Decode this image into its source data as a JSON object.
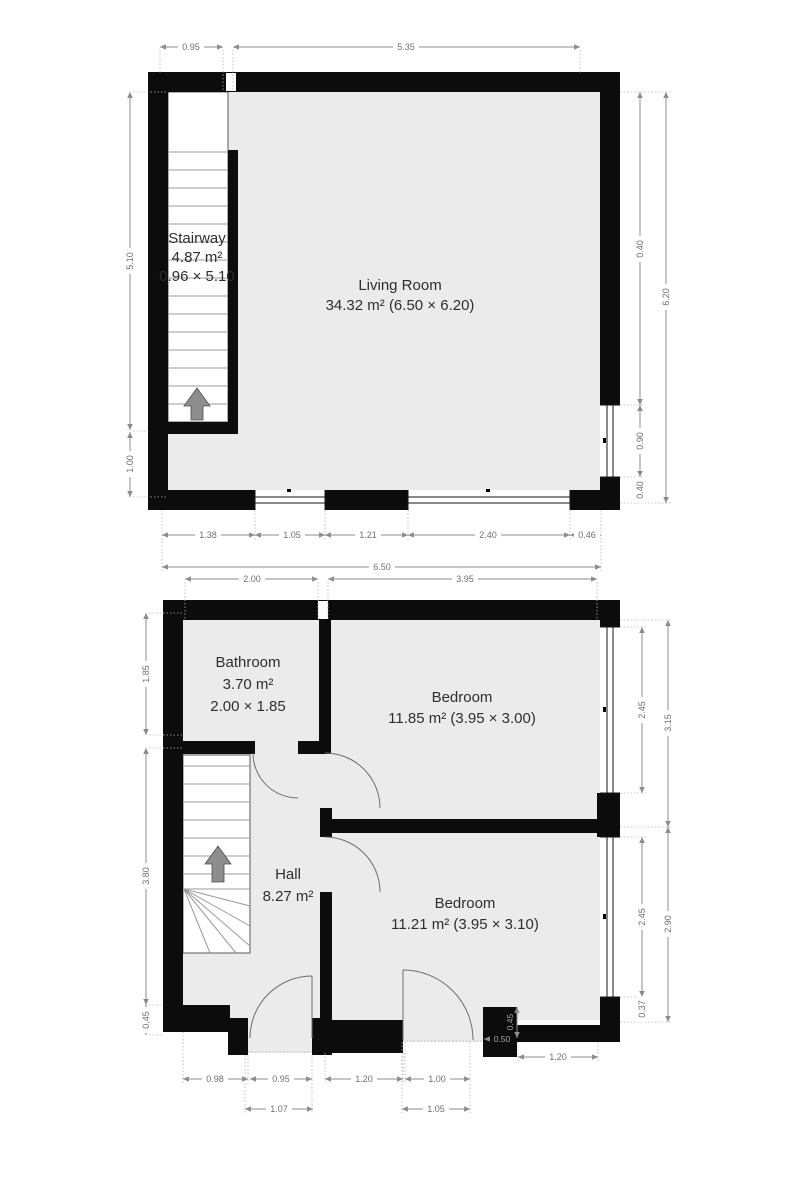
{
  "floor1": {
    "rooms": {
      "stairway": {
        "name": "Stairway",
        "area": "4.87 m²",
        "size": "0.96 × 5.10"
      },
      "living_room": {
        "name": "Living Room",
        "detail": "34.32 m² (6.50 × 6.20)"
      }
    },
    "dims": {
      "top_left": "0.95",
      "top_main": "5.35",
      "left_upper": "5.10",
      "left_lower": "1.00",
      "right_upper": "0.40",
      "right_window": "0.90",
      "right_lower": "0.40",
      "right_total": "6.20",
      "bottom_segments": [
        "1.38",
        "1.05",
        "1.21",
        "2.40",
        "0.46"
      ],
      "width_total": "6.50"
    }
  },
  "floor2": {
    "rooms": {
      "bathroom": {
        "name": "Bathroom",
        "area": "3.70 m²",
        "size": "2.00 × 1.85"
      },
      "bedroom_top": {
        "name": "Bedroom",
        "detail": "11.85 m² (3.95 × 3.00)"
      },
      "hall": {
        "name": "Hall",
        "area": "8.27 m²"
      },
      "bedroom_bottom": {
        "name": "Bedroom",
        "detail": "11.21 m² (3.95 × 3.10)"
      }
    },
    "dims": {
      "top_left": "2.00",
      "top_right": "3.95",
      "left_upper": "1.85",
      "left_mid": "3.80",
      "left_lower": "0.45",
      "right_window_top": "2.45",
      "right_section_top": "3.15",
      "right_window_bottom": "2.45",
      "right_section_bottom": "2.90",
      "right_step": "0.37",
      "bottom_right": "1.20",
      "bottom_segments": [
        "0.98",
        "0.95",
        "1.20",
        "1.00"
      ],
      "bottom_openings": [
        "1.07",
        "1.05"
      ],
      "step_width": "0.50",
      "step_height": "0.45"
    }
  },
  "colors": {
    "wall": "#0c0c0c",
    "floor": "#ebebeb",
    "dimension": "#8c8c8c",
    "room_text": "#2e2e2e"
  }
}
